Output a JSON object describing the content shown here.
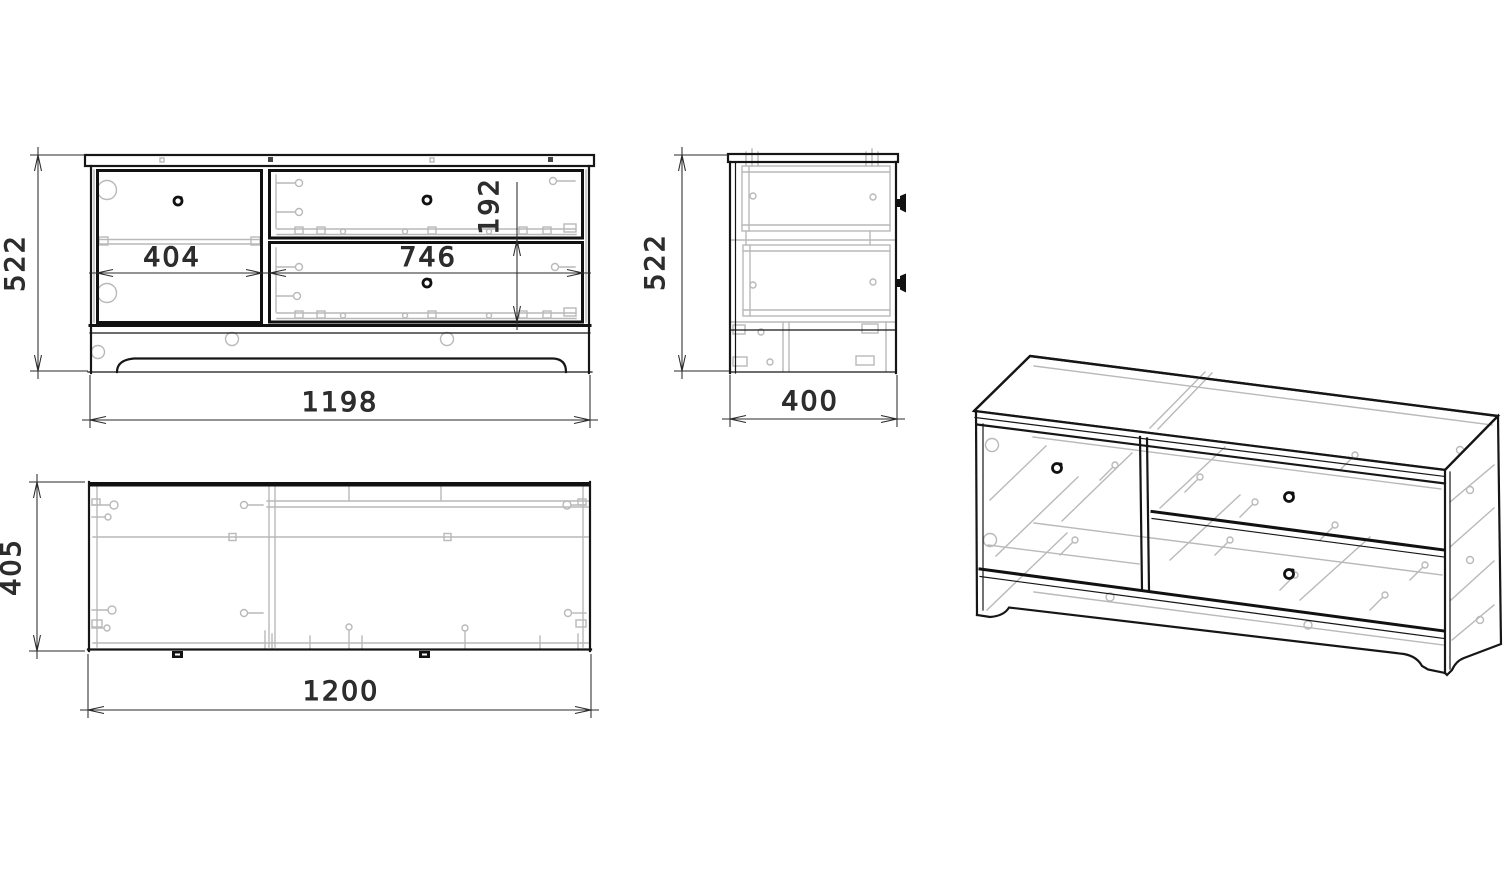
{
  "drawing": {
    "type": "furniture-technical-drawing",
    "views": {
      "front": {
        "height_mm": "522",
        "width_mm": "1198",
        "door_width_mm": "404",
        "drawers_width_mm": "746",
        "drawer_front_height_mm": "192"
      },
      "side": {
        "height_mm": "522",
        "depth_mm": "400"
      },
      "top": {
        "depth_mm": "405",
        "width_mm": "1200"
      }
    },
    "colors": {
      "line": "#161616",
      "hidden_line": "#b9b9b9",
      "dimension_text": "#2f2f2f",
      "background": "#ffffff"
    }
  }
}
